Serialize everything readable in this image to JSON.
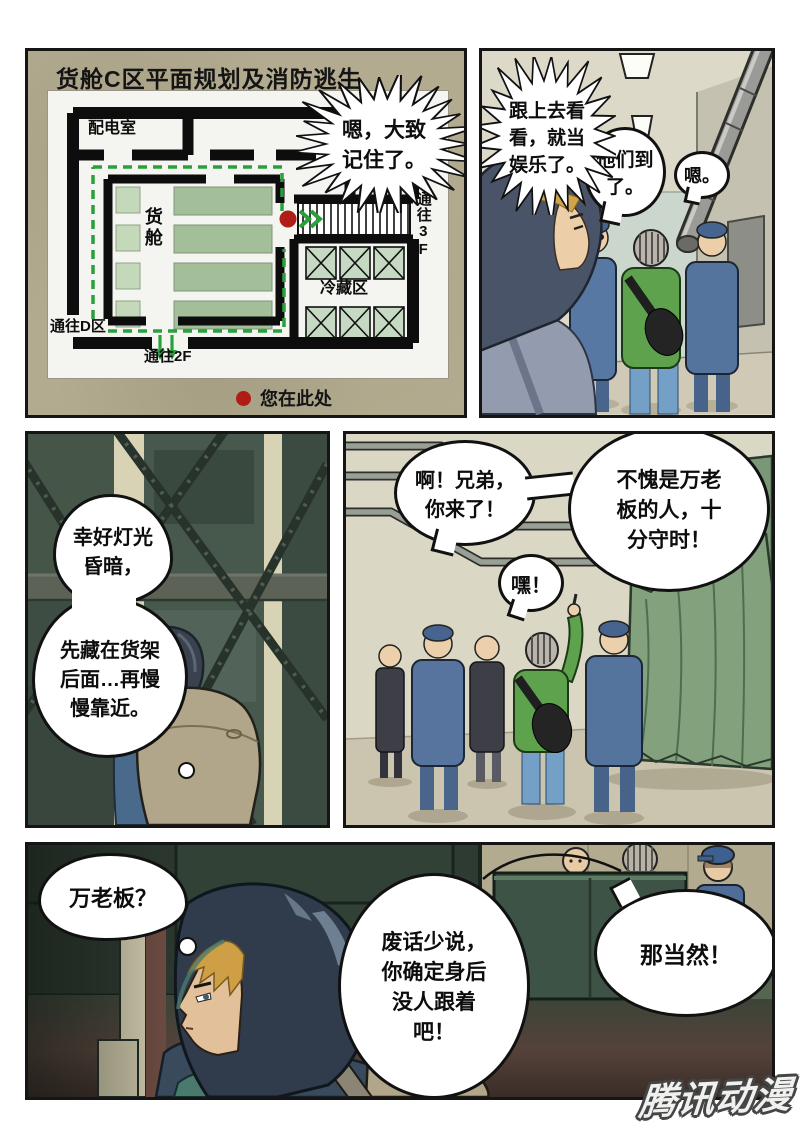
{
  "watermark": "腾讯动漫",
  "colors": {
    "route_green": "#2aa03c",
    "marker_red": "#b01d17",
    "map_khaki": "#b2ab8f",
    "uniform_blue": "#5778a3",
    "jacket_green": "#5ea24d",
    "tarp_green": "#7e9b7a"
  },
  "panel1": {
    "title": "货舱C区平面规划及消防逃生",
    "bubble_memorized": "嗯，大致记住了。",
    "map": {
      "power_room": "配电室",
      "cargo_hold": "货舱",
      "to_3f": "通往3F",
      "cold_zone": "冷藏区",
      "to_d_zone": "通往D区",
      "to_2f": "通往2F",
      "you_are_here": "您在此处"
    }
  },
  "panel2": {
    "burst_follow": "跟上去看看，就当娱乐了。",
    "bubble_arrived": "他们到了。",
    "bubble_hmm": "嗯。"
  },
  "panel3": {
    "thought_light": "幸好灯光昏暗，",
    "thought_hide": "先藏在货架后面…再慢慢靠近。"
  },
  "panel4": {
    "bubble_brother": "啊！兄弟，你来了！",
    "bubble_punctual": "不愧是万老板的人，十分守时！",
    "bubble_hey": "嘿！"
  },
  "panel5": {
    "thought_boss": "万老板？",
    "bubble_no_nonsense": "废话少说，你确定身后没人跟着吧！",
    "bubble_of_course": "那当然！"
  }
}
